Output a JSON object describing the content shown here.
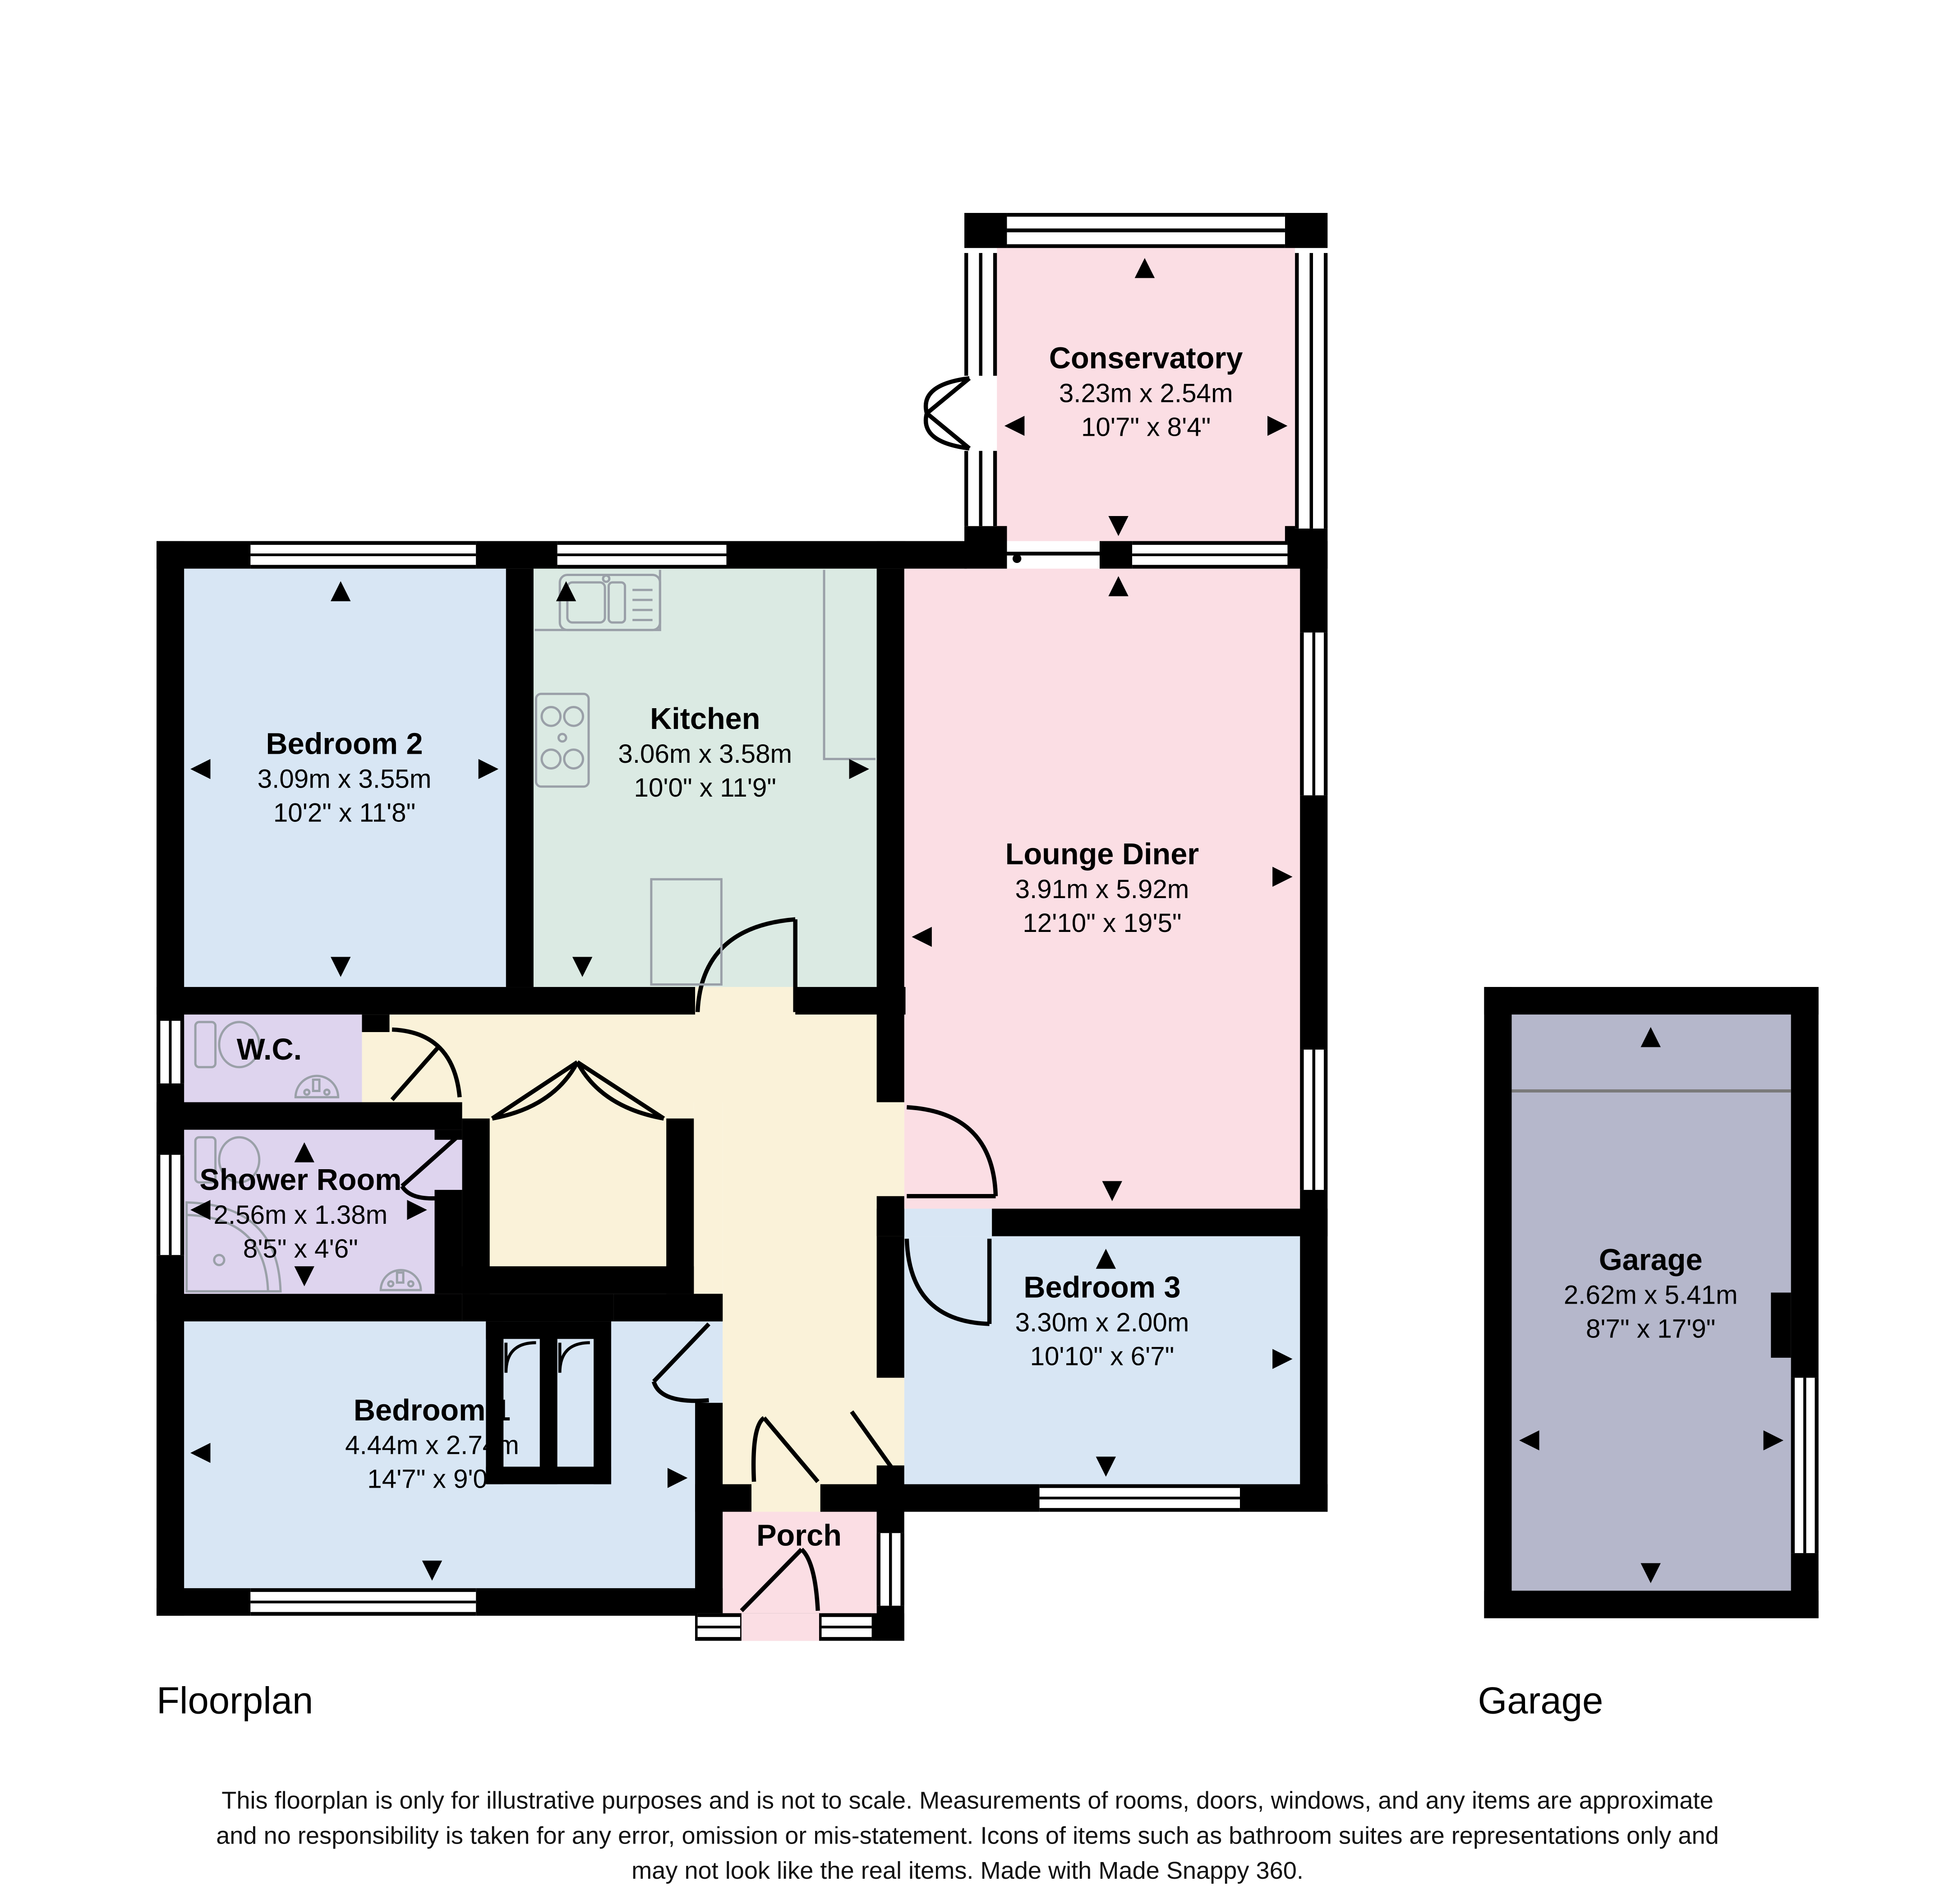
{
  "rooms": [
    {
      "id": "conservatory",
      "name": "Conservatory",
      "metric": "3.23m x 2.54m",
      "imperial": "10'7\" x 8'4\""
    },
    {
      "id": "bedroom2",
      "name": "Bedroom 2",
      "metric": "3.09m x 3.55m",
      "imperial": "10'2\" x 11'8\""
    },
    {
      "id": "kitchen",
      "name": "Kitchen",
      "metric": "3.06m x 3.58m",
      "imperial": "10'0\" x 11'9\""
    },
    {
      "id": "lounge_diner",
      "name": "Lounge Diner",
      "metric": "3.91m x 5.92m",
      "imperial": "12'10\" x 19'5\""
    },
    {
      "id": "wc",
      "name": "W.C.",
      "metric": "",
      "imperial": ""
    },
    {
      "id": "shower_room",
      "name": "Shower Room",
      "metric": "2.56m x 1.38m",
      "imperial": "8'5\" x 4'6\""
    },
    {
      "id": "bedroom1",
      "name": "Bedroom 1",
      "metric": "4.44m x 2.74m",
      "imperial": "14'7\" x 9'0\""
    },
    {
      "id": "bedroom3",
      "name": "Bedroom 3",
      "metric": "3.30m x 2.00m",
      "imperial": "10'10\" x 6'7\""
    },
    {
      "id": "porch",
      "name": "Porch",
      "metric": "",
      "imperial": ""
    },
    {
      "id": "garage",
      "name": "Garage",
      "metric": "2.62m x 5.41m",
      "imperial": "8'7\" x 17'9\""
    }
  ],
  "sections": {
    "floorplan_label": "Floorplan",
    "garage_label": "Garage"
  },
  "footer": {
    "disclaimer_line1": "This floorplan is only for illustrative purposes and is not to scale. Measurements of rooms, doors, windows, and any items are approximate",
    "disclaimer_line2": "and no responsibility is taken for any error, omission or mis-statement. Icons of items such as bathroom suites are representations only and",
    "disclaimer_line3": "may not look like the real items. Made with Made Snappy 360."
  },
  "colors": {
    "wall": "#000000",
    "bedroom_fill": "#d8e6f4",
    "kitchen_fill": "#dbeae3",
    "lounge_fill": "#fbdee4",
    "bathroom_fill": "#ded4ee",
    "hall_fill": "#faf2d9",
    "garage_fill": "#b5b7cb",
    "fixture_stroke": "#9aa0a8"
  }
}
